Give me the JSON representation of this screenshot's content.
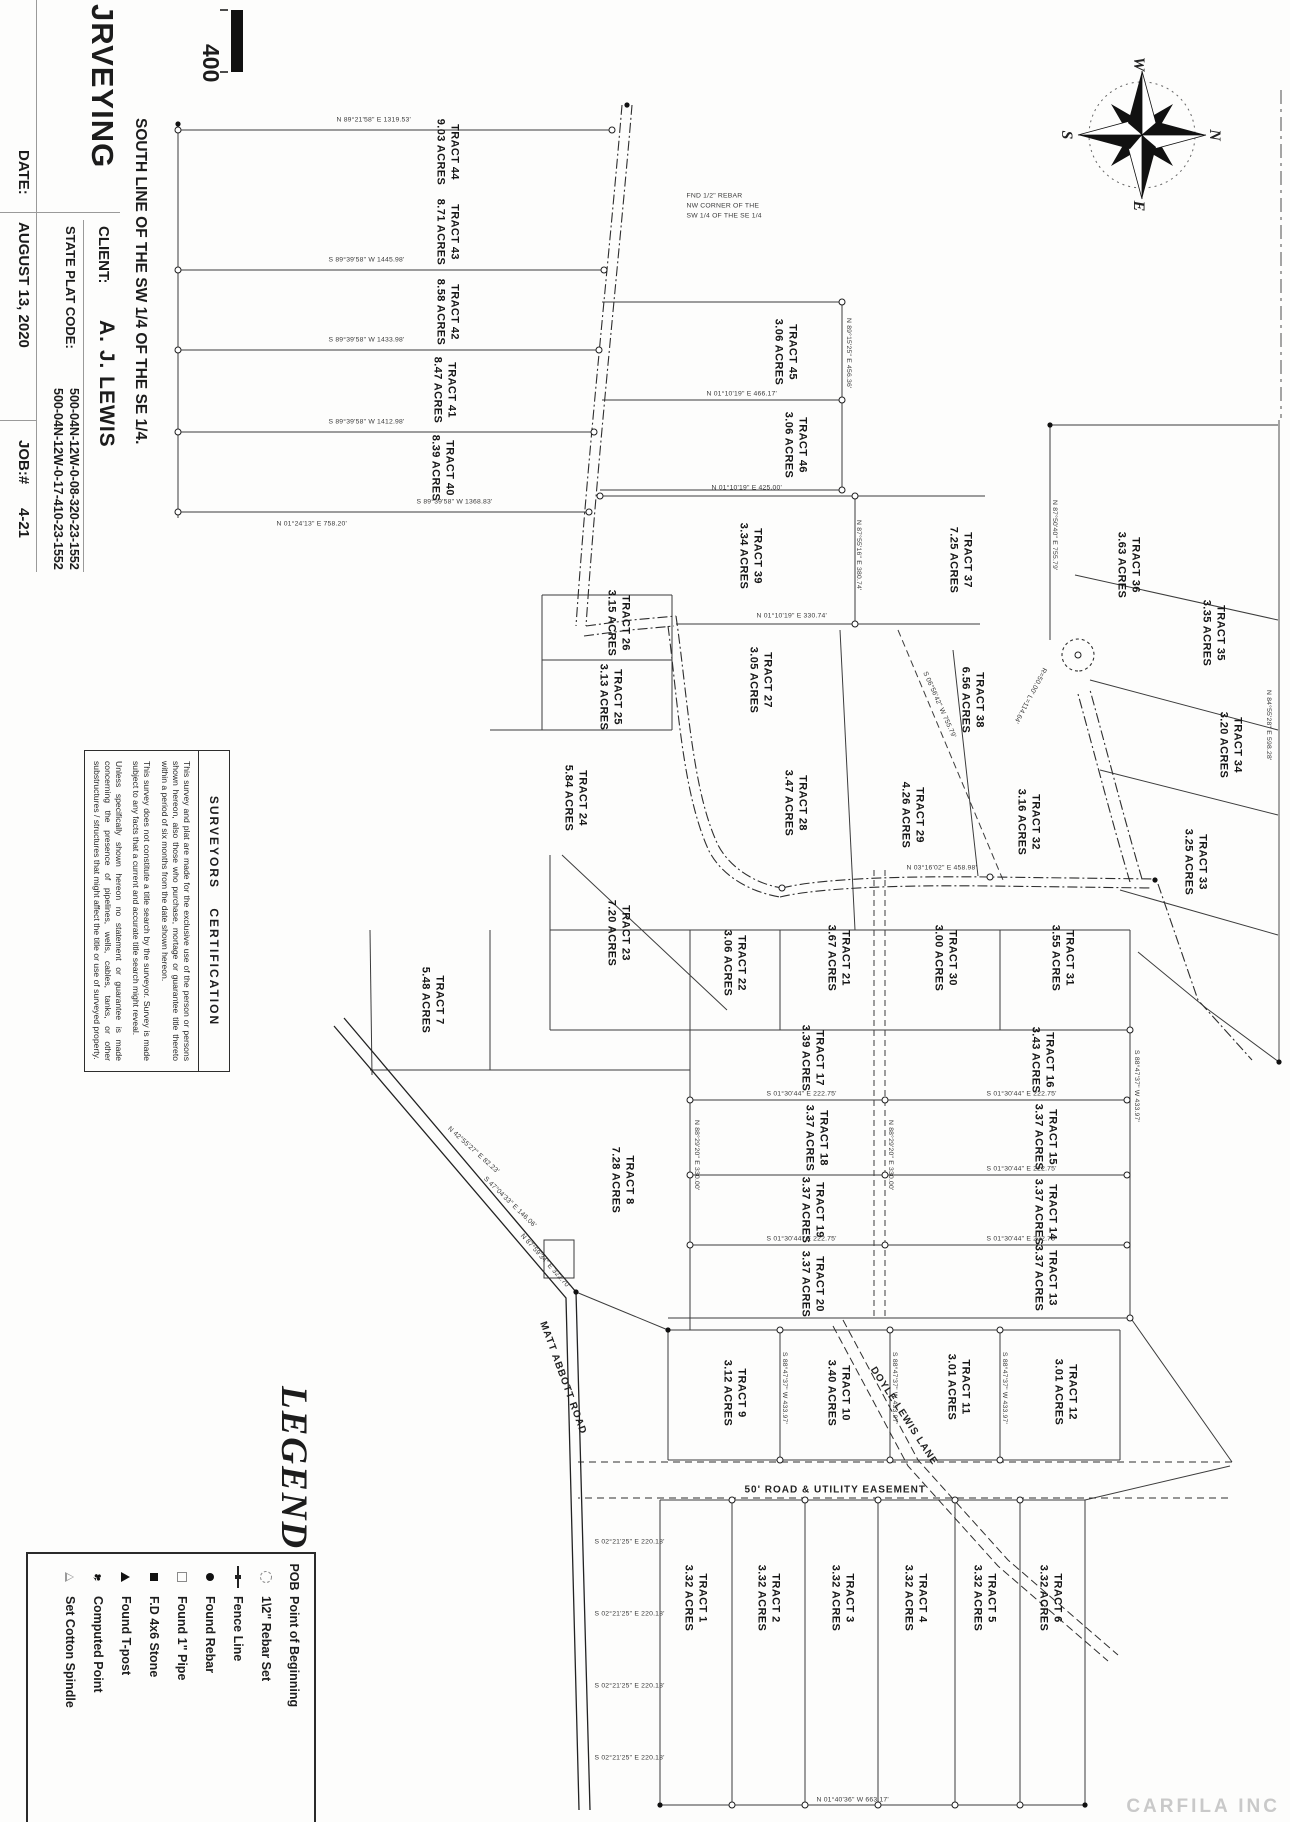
{
  "title_block": {
    "firm_partial": "JRVEYING",
    "location_line": "SOUTH LINE OF THE SW 1/4 OF THE SE 1/4.",
    "client_label": "CLIENT:",
    "client_name": "A. J. LEWIS",
    "plat_code_label": "STATE PLAT CODE:",
    "plat_codes": [
      "500-04N-12W-0-08-320-23-1552",
      "500-04N-12W-0-17-410-23-1552"
    ],
    "date_label": "DATE:",
    "date_value": "AUGUST 13, 2020",
    "job_label": "JOB:#",
    "job_value": "4-21"
  },
  "scale": {
    "value": "400"
  },
  "compass": {
    "n": "N",
    "s": "S",
    "e": "E",
    "w": "W"
  },
  "watermark": "CARFILA INC",
  "legend": {
    "title": "LEGEND",
    "items": [
      {
        "icon": "pob",
        "prefix": "POB",
        "label": "Point of Beginning"
      },
      {
        "icon": "circle-dashed",
        "prefix": "",
        "label": "1\\2\" Rebar Set"
      },
      {
        "icon": "fence",
        "prefix": "",
        "label": "Fence Line"
      },
      {
        "icon": "dot",
        "prefix": "",
        "label": "Found Rebar"
      },
      {
        "icon": "square-open",
        "prefix": "",
        "label": "Found 1\" Pipe"
      },
      {
        "icon": "square-filled",
        "prefix": "",
        "label": "F.D 4x6 Stone"
      },
      {
        "icon": "tri-filled",
        "prefix": "",
        "label": "Found T-post"
      },
      {
        "icon": "club",
        "prefix": "",
        "label": "Computed Point"
      },
      {
        "icon": "tri-open",
        "prefix": "",
        "label": "Set Cotton Spindle"
      }
    ]
  },
  "certification": {
    "heading": "SURVEYORS CERTIFICATION",
    "paragraphs": [
      "This survey and plat are made for the exclusive use of the person or persons shown hereon, also those who purchase, mortage or guarantee title thereto within a period of six months from the date shown hereon.",
      "This survey does not constitute a title search by the surveyor. Survey is made subject to any facts that a current and accurate title search might reveal.",
      "Unless specifically shown hereon no statement or guarantee is made concerning the presence of pipelines, wells, cables, tanks, or other substructures / structures that might affect the title or use of surveyed property."
    ]
  },
  "roads": [
    {
      "name": "MATT ABBOTT ROAD",
      "x": 1322,
      "y": 742,
      "r": -20
    },
    {
      "name": "DOYLE LEWIS LANE",
      "x": 1368,
      "y": 412,
      "r": -33
    },
    {
      "name": "50' ROAD & UTILITY EASEMENT",
      "x": 1490,
      "y": 540,
      "r": -90
    }
  ],
  "tracts": [
    {
      "id": "TRACT 44",
      "acres": "9.03 ACRES",
      "x": 152,
      "y": 843
    },
    {
      "id": "TRACT 43",
      "acres": "8.71 ACRES",
      "x": 232,
      "y": 843
    },
    {
      "id": "TRACT 42",
      "acres": "8.58 ACRES",
      "x": 312,
      "y": 843
    },
    {
      "id": "TRACT 41",
      "acres": "8.47 ACRES",
      "x": 390,
      "y": 846
    },
    {
      "id": "TRACT 40",
      "acres": "8.39 ACRES",
      "x": 468,
      "y": 848
    },
    {
      "id": "TRACT 45",
      "acres": "3.06 ACRES",
      "x": 352,
      "y": 505
    },
    {
      "id": "TRACT 46",
      "acres": "3.06 ACRES",
      "x": 445,
      "y": 495
    },
    {
      "id": "TRACT 39",
      "acres": "3.34 ACRES",
      "x": 556,
      "y": 540
    },
    {
      "id": "TRACT 37",
      "acres": "7.25 ACRES",
      "x": 560,
      "y": 330
    },
    {
      "id": "TRACT 36",
      "acres": "3.63 ACRES",
      "x": 565,
      "y": 162
    },
    {
      "id": "TRACT 35",
      "acres": "3.35 ACRES",
      "x": 633,
      "y": 77
    },
    {
      "id": "TRACT 34",
      "acres": "3.20 ACRES",
      "x": 745,
      "y": 60
    },
    {
      "id": "TRACT 33",
      "acres": "3.25 ACRES",
      "x": 862,
      "y": 95
    },
    {
      "id": "TRACT 38",
      "acres": "6.56 ACRES",
      "x": 700,
      "y": 318
    },
    {
      "id": "TRACT 32",
      "acres": "3.16 ACRES",
      "x": 822,
      "y": 262
    },
    {
      "id": "TRACT 29",
      "acres": "4.26 ACRES",
      "x": 815,
      "y": 378
    },
    {
      "id": "TRACT 28",
      "acres": "3.47 ACRES",
      "x": 803,
      "y": 495
    },
    {
      "id": "TRACT 27",
      "acres": "3.05 ACRES",
      "x": 680,
      "y": 530
    },
    {
      "id": "TRACT 26",
      "acres": "3.15 ACRES",
      "x": 623,
      "y": 672
    },
    {
      "id": "TRACT 25",
      "acres": "3.13 ACRES",
      "x": 697,
      "y": 680
    },
    {
      "id": "TRACT 24",
      "acres": "5.84 ACRES",
      "x": 798,
      "y": 715
    },
    {
      "id": "TRACT 23",
      "acres": "7.20 ACRES",
      "x": 933,
      "y": 672
    },
    {
      "id": "TRACT 22",
      "acres": "3.06 ACRES",
      "x": 963,
      "y": 556
    },
    {
      "id": "TRACT 21",
      "acres": "3.67 ACRES",
      "x": 958,
      "y": 452
    },
    {
      "id": "TRACT 30",
      "acres": "3.00 ACRES",
      "x": 958,
      "y": 345
    },
    {
      "id": "TRACT 31",
      "acres": "3.55 ACRES",
      "x": 958,
      "y": 228
    },
    {
      "id": "TRACT 16",
      "acres": "3.43 ACRES",
      "x": 1060,
      "y": 248
    },
    {
      "id": "TRACT 15",
      "acres": "3.37 ACRES",
      "x": 1137,
      "y": 245
    },
    {
      "id": "TRACT 14",
      "acres": "3.37 ACRES",
      "x": 1212,
      "y": 245
    },
    {
      "id": "TRACT 13",
      "acres": "3.37 ACRES",
      "x": 1278,
      "y": 245
    },
    {
      "id": "TRACT 17",
      "acres": "3.39 ACRES",
      "x": 1058,
      "y": 478
    },
    {
      "id": "TRACT 18",
      "acres": "3.37 ACRES",
      "x": 1138,
      "y": 474
    },
    {
      "id": "TRACT 19",
      "acres": "3.37 ACRES",
      "x": 1210,
      "y": 478
    },
    {
      "id": "TRACT 20",
      "acres": "3.37 ACRES",
      "x": 1284,
      "y": 478
    },
    {
      "id": "TRACT 12",
      "acres": "3.01 ACRES",
      "x": 1392,
      "y": 225
    },
    {
      "id": "TRACT 11",
      "acres": "3.01 ACRES",
      "x": 1387,
      "y": 332
    },
    {
      "id": "TRACT 10",
      "acres": "3.40 ACRES",
      "x": 1393,
      "y": 452
    },
    {
      "id": "TRACT 9",
      "acres": "3.12 ACRES",
      "x": 1393,
      "y": 556
    },
    {
      "id": "TRACT 8",
      "acres": "7.28 ACRES",
      "x": 1180,
      "y": 668
    },
    {
      "id": "TRACT 7",
      "acres": "5.48 ACRES",
      "x": 1000,
      "y": 858
    },
    {
      "id": "TRACT 6",
      "acres": "3.32 ACRES",
      "x": 1598,
      "y": 240
    },
    {
      "id": "TRACT 5",
      "acres": "3.32 ACRES",
      "x": 1598,
      "y": 306
    },
    {
      "id": "TRACT 4",
      "acres": "3.32 ACRES",
      "x": 1598,
      "y": 375
    },
    {
      "id": "TRACT 3",
      "acres": "3.32 ACRES",
      "x": 1598,
      "y": 448
    },
    {
      "id": "TRACT 2",
      "acres": "3.32 ACRES",
      "x": 1598,
      "y": 522
    },
    {
      "id": "TRACT 1",
      "acres": "3.32 ACRES",
      "x": 1598,
      "y": 595
    }
  ],
  "bearings": [
    {
      "t": "N 89°21'58\" E  1319.53'",
      "x": 120,
      "y": 950,
      "r": -90
    },
    {
      "t": "S 89°39'58\" W  1445.98'",
      "x": 260,
      "y": 958,
      "r": -90
    },
    {
      "t": "S 89°39'58\" W  1433.98'",
      "x": 340,
      "y": 958,
      "r": -90
    },
    {
      "t": "S 89°39'58\" W  1412.98'",
      "x": 422,
      "y": 958,
      "r": -90
    },
    {
      "t": "S 89°39'58\" W  1368.83'",
      "x": 502,
      "y": 870,
      "r": -90
    },
    {
      "t": "N 01°24'13\" E  758.20'",
      "x": 524,
      "y": 1010,
      "r": -90
    },
    {
      "t": "N 89°15'25\" E  456.36'",
      "x": 318,
      "y": 438,
      "r": 0
    },
    {
      "t": "N 01°10'19\" E  466.17'",
      "x": 394,
      "y": 580,
      "r": -90
    },
    {
      "t": "N 01°10'19\" E  425.00'",
      "x": 488,
      "y": 575,
      "r": -90
    },
    {
      "t": "N 01°10'19\" E  330.74'",
      "x": 616,
      "y": 530,
      "r": -90
    },
    {
      "t": "N 87°55'16\" E  380.74'",
      "x": 520,
      "y": 428,
      "r": 0
    },
    {
      "t": "N 87°50'40\" E  755.79'",
      "x": 500,
      "y": 232,
      "r": 0
    },
    {
      "t": "S 06°56'42\" W  755.79'",
      "x": 672,
      "y": 362,
      "r": -24
    },
    {
      "t": "N 84°55'28\" E  598.28'",
      "x": 690,
      "y": 18,
      "r": 0
    },
    {
      "t": "N 03°16'02\" E  458.98'",
      "x": 868,
      "y": 380,
      "r": -90
    },
    {
      "t": "S 88°47'37\" W  433.97'",
      "x": 1050,
      "y": 150,
      "r": 0
    },
    {
      "t": "N 88°29'20\" E  330.00'",
      "x": 1120,
      "y": 396,
      "r": 0
    },
    {
      "t": "N 88°29'20\" E  330.00'",
      "x": 1120,
      "y": 590,
      "r": 0
    },
    {
      "t": "S 01°30'44\" E  222.75'",
      "x": 1094,
      "y": 300,
      "r": -90
    },
    {
      "t": "S 01°30'44\" E  222.75'",
      "x": 1169,
      "y": 300,
      "r": -90
    },
    {
      "t": "S 01°30'44\" E  222.75'",
      "x": 1239,
      "y": 300,
      "r": -90
    },
    {
      "t": "S 01°30'44\" E  222.75'",
      "x": 1094,
      "y": 520,
      "r": -90
    },
    {
      "t": "S 01°30'44\" E  222.75'",
      "x": 1239,
      "y": 520,
      "r": -90
    },
    {
      "t": "S 88°47'37\" W  433.97'",
      "x": 1352,
      "y": 282,
      "r": 0
    },
    {
      "t": "S 88°47'37\" W  433.97'",
      "x": 1352,
      "y": 392,
      "r": 0
    },
    {
      "t": "S 88°47'37\" W  433.97'",
      "x": 1352,
      "y": 502,
      "r": 0
    },
    {
      "t": "S 02°21'25\" E  220.18'",
      "x": 1542,
      "y": 692,
      "r": -90
    },
    {
      "t": "S 02°21'25\" E  220.18'",
      "x": 1614,
      "y": 692,
      "r": -90
    },
    {
      "t": "S 02°21'25\" E  220.18'",
      "x": 1686,
      "y": 692,
      "r": -90
    },
    {
      "t": "S 02°21'25\" E  220.18'",
      "x": 1758,
      "y": 692,
      "r": -90
    },
    {
      "t": "N 01°40'36\" W  663.17'",
      "x": 1800,
      "y": 470,
      "r": -90
    },
    {
      "t": "N 87°59'34\" E  322.70'",
      "x": 1235,
      "y": 765,
      "r": -42
    },
    {
      "t": "S 47°04'33\" E  146.06'",
      "x": 1178,
      "y": 802,
      "r": -46
    },
    {
      "t": "N 42°55'27\" E  82.23'",
      "x": 1128,
      "y": 838,
      "r": -48
    },
    {
      "t": "R=50.00'  L=114.64'",
      "x": 668,
      "y": 242,
      "r": 28
    },
    {
      "t": "FND 1/2\" REBAR",
      "x": 196,
      "y": 600,
      "r": -90
    },
    {
      "t": "NW CORNER OF THE",
      "x": 206,
      "y": 600,
      "r": -90
    },
    {
      "t": "SW 1/4 OF THE SE 1/4",
      "x": 216,
      "y": 600,
      "r": -90
    }
  ]
}
